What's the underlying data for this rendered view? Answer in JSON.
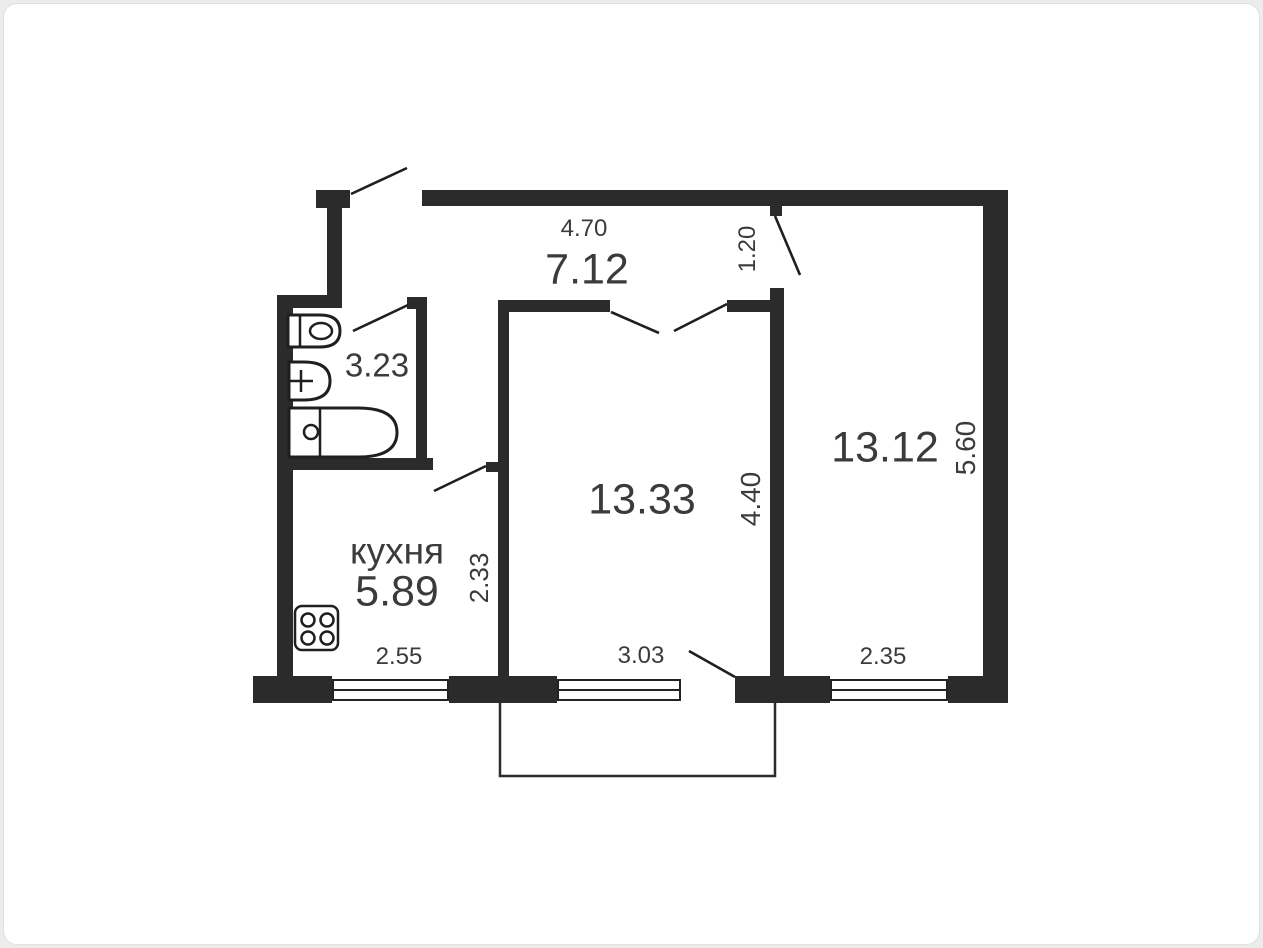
{
  "plan": {
    "type": "apartment-floor-plan",
    "rooms": [
      {
        "id": "hallway",
        "name": "",
        "area": "7.12",
        "dims": {
          "width": "4.70",
          "door": "1.20"
        }
      },
      {
        "id": "bathroom",
        "name": "",
        "area": "3.23",
        "dims": {}
      },
      {
        "id": "kitchen",
        "name": "кухня",
        "area": "5.89",
        "dims": {
          "width": "2.55",
          "depth": "2.33"
        }
      },
      {
        "id": "living-room",
        "name": "",
        "area": "13.33",
        "dims": {
          "width": "3.03",
          "depth": "4.40"
        }
      },
      {
        "id": "bedroom",
        "name": "",
        "area": "13.12",
        "dims": {
          "width": "2.35",
          "depth": "5.60"
        }
      }
    ],
    "fixtures": [
      "toilet-icon",
      "sink-icon",
      "bathtub-icon",
      "stove-icon"
    ],
    "features": [
      "balcony-outline",
      "entry-door-swing",
      "bathroom-door-swing",
      "kitchen-door-swing",
      "living-room-double-door-swing",
      "bedroom-door-swing",
      "balcony-door-swing",
      "windows-x3"
    ],
    "colors": {
      "wall": "#2b2b2b",
      "text": "#3b3b3b",
      "floor": "#ffffff",
      "page_bg": "#ececec",
      "card_border": "#e0e0e0"
    }
  }
}
